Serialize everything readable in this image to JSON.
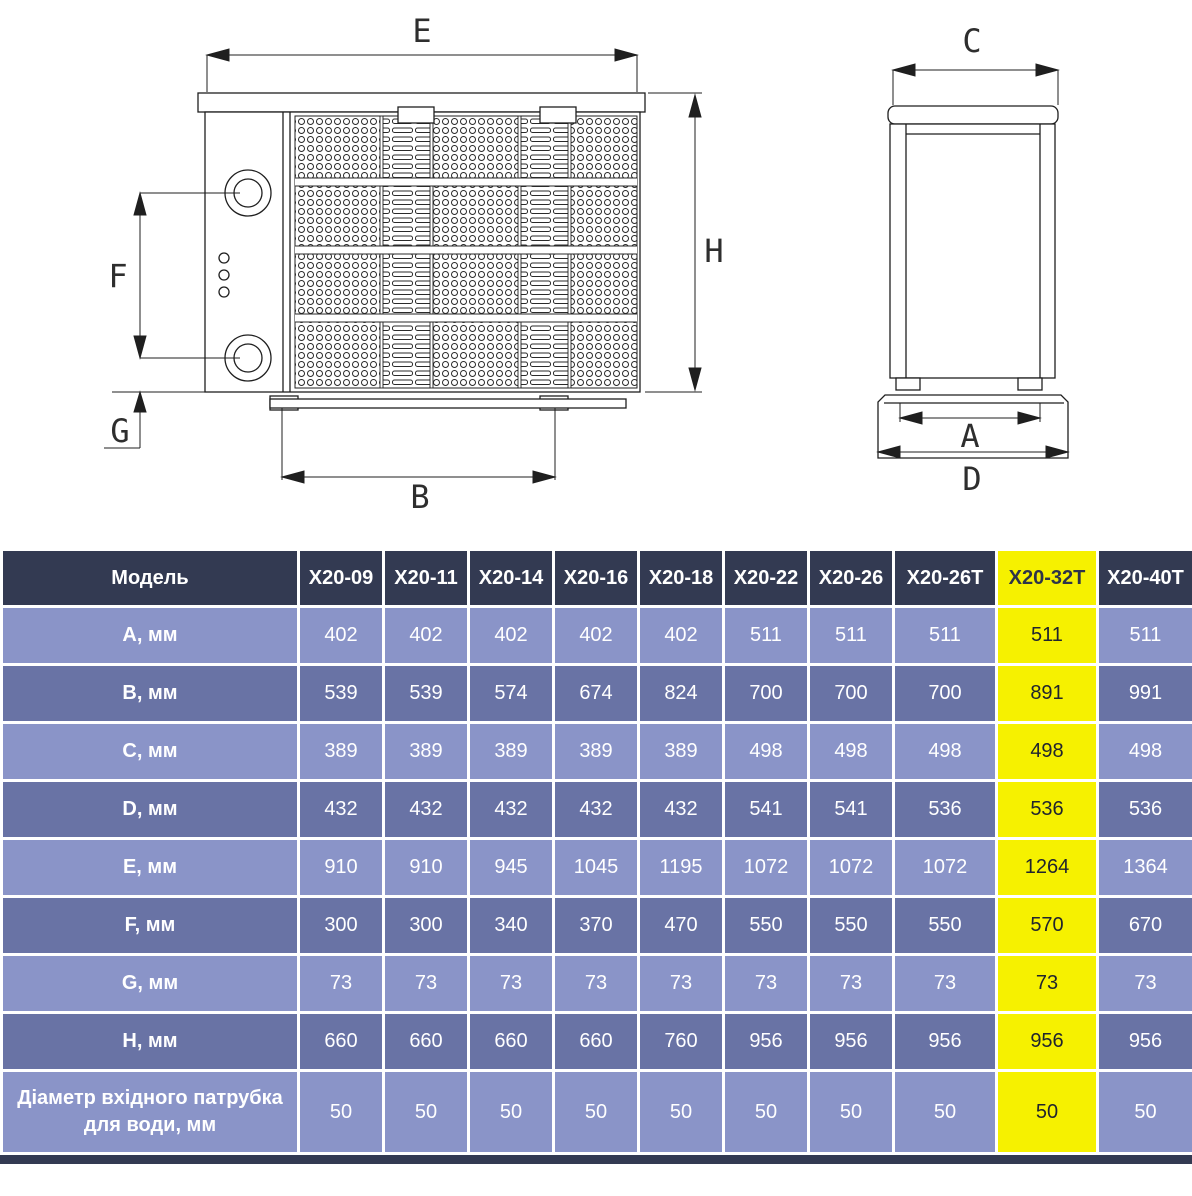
{
  "diagram": {
    "labels": {
      "E": "E",
      "H": "H",
      "F": "F",
      "G": "G",
      "B": "B",
      "C": "C",
      "A": "A",
      "D": "D"
    }
  },
  "table": {
    "header": {
      "model_label": "Модель",
      "columns": [
        "X20-09",
        "X20-11",
        "X20-14",
        "X20-16",
        "X20-18",
        "X20-22",
        "X20-26",
        "X20-26T",
        "X20-32T",
        "X20-40T"
      ]
    },
    "highlight_column": "X20-32T",
    "rows": [
      {
        "label": "A, мм",
        "values": [
          "402",
          "402",
          "402",
          "402",
          "402",
          "511",
          "511",
          "511",
          "511",
          "511"
        ]
      },
      {
        "label": "B, мм",
        "values": [
          "539",
          "539",
          "574",
          "674",
          "824",
          "700",
          "700",
          "700",
          "891",
          "991"
        ]
      },
      {
        "label": "C, мм",
        "values": [
          "389",
          "389",
          "389",
          "389",
          "389",
          "498",
          "498",
          "498",
          "498",
          "498"
        ]
      },
      {
        "label": "D, мм",
        "values": [
          "432",
          "432",
          "432",
          "432",
          "432",
          "541",
          "541",
          "536",
          "536",
          "536"
        ]
      },
      {
        "label": "E, мм",
        "values": [
          "910",
          "910",
          "945",
          "1045",
          "1195",
          "1072",
          "1072",
          "1072",
          "1264",
          "1364"
        ]
      },
      {
        "label": "F, мм",
        "values": [
          "300",
          "300",
          "340",
          "370",
          "470",
          "550",
          "550",
          "550",
          "570",
          "670"
        ]
      },
      {
        "label": "G, мм",
        "values": [
          "73",
          "73",
          "73",
          "73",
          "73",
          "73",
          "73",
          "73",
          "73",
          "73"
        ]
      },
      {
        "label": "H, мм",
        "values": [
          "660",
          "660",
          "660",
          "660",
          "760",
          "956",
          "956",
          "956",
          "956",
          "956"
        ]
      },
      {
        "label": "Діаметр вхідного патрубка для води, мм",
        "values": [
          "50",
          "50",
          "50",
          "50",
          "50",
          "50",
          "50",
          "50",
          "50",
          "50"
        ]
      }
    ]
  },
  "colors": {
    "header_bg": "#333a52",
    "row_light": "#8a94c8",
    "row_dark": "#6973a5",
    "highlight": "#f6f100",
    "grid": "#ffffff"
  }
}
